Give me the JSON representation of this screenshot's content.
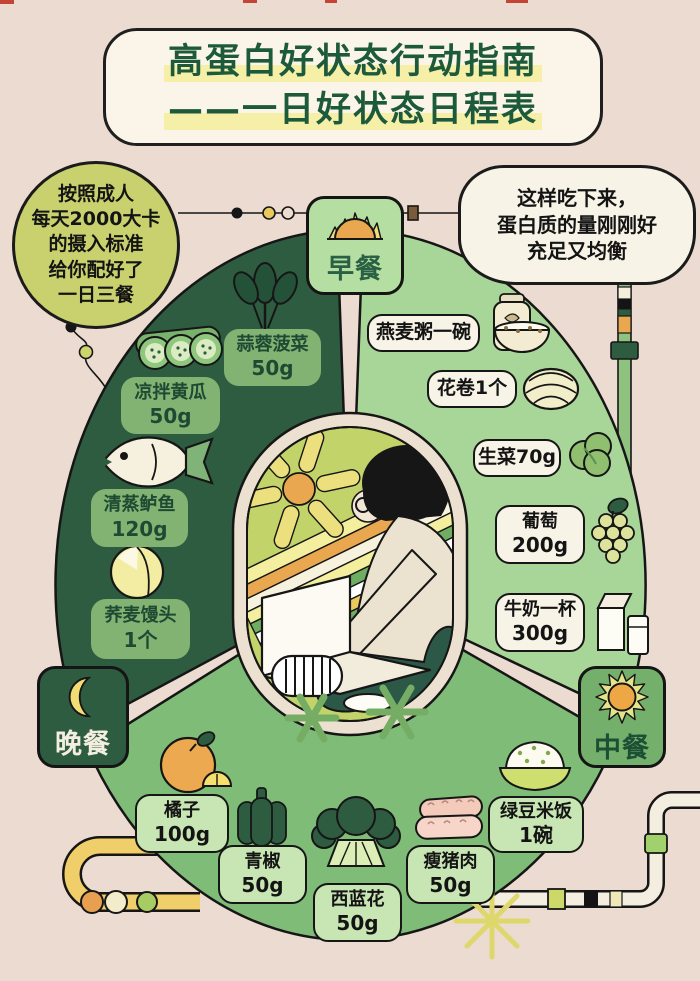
{
  "title": {
    "line1": "高蛋白好状态行动指南",
    "line2": "——一日好状态日程表"
  },
  "bubbles": {
    "left": {
      "lines": [
        "按照成人",
        "每天2000大卡",
        "的摄入标准",
        "给你配好了",
        "一日三餐"
      ]
    },
    "right": {
      "lines": [
        "这样吃下来，",
        "蛋白质的量刚刚好",
        "充足又均衡"
      ]
    }
  },
  "meals": {
    "breakfast": {
      "label": "早餐",
      "icon": "rising-sun-icon",
      "items": [
        {
          "line1": "燕麦粥一碗",
          "icon": "oatmeal-bowl-icon"
        },
        {
          "line1": "花卷1个",
          "icon": "steamed-roll-icon"
        },
        {
          "line1": "生菜70g",
          "icon": "lettuce-icon"
        },
        {
          "line1": "葡萄",
          "line2": "200g",
          "icon": "grapes-icon"
        },
        {
          "line1": "牛奶一杯",
          "line2": "300g",
          "icon": "milk-icon"
        }
      ]
    },
    "lunch": {
      "label": "中餐",
      "icon": "sun-icon",
      "items": [
        {
          "line1": "橘子",
          "line2": "100g",
          "icon": "tangerine-icon"
        },
        {
          "line1": "青椒",
          "line2": "50g",
          "icon": "green-pepper-icon"
        },
        {
          "line1": "西蓝花",
          "line2": "50g",
          "icon": "broccoli-icon"
        },
        {
          "line1": "瘦猪肉",
          "line2": "50g",
          "icon": "lean-pork-icon"
        },
        {
          "line1": "绿豆米饭",
          "line2": "1碗",
          "icon": "rice-bowl-icon"
        }
      ]
    },
    "dinner": {
      "label": "晚餐",
      "icon": "moon-icon",
      "items": [
        {
          "line1": "蒜蓉菠菜",
          "line2": "50g",
          "icon": "spinach-icon"
        },
        {
          "line1": "凉拌黄瓜",
          "line2": "50g",
          "icon": "cucumber-icon"
        },
        {
          "line1": "清蒸鲈鱼",
          "line2": "120g",
          "icon": "steamed-fish-icon"
        },
        {
          "line1": "荞麦馒头",
          "line2": "1个",
          "icon": "buckwheat-bun-icon"
        }
      ]
    }
  },
  "colors": {
    "background": "#ecdbd0",
    "title_text": "#1d5a3b",
    "title_highlight": "#f5efa8",
    "dinner_section": "#2e5c40",
    "breakfast_section": "#a8d698",
    "lunch_section": "#7fbc78",
    "dinner_label_box": "#82b373",
    "breakfast_label_box": "#f7f3e6",
    "lunch_label_box": "#c8e5b4",
    "badge_breakfast": "#b5dfa2",
    "badge_lunch": "#74b06c",
    "badge_dinner": "#2e5c40",
    "bubble_left": "#c9d06e",
    "bubble_right": "#f7f3e7",
    "accent_orange": "#e9a84f",
    "accent_yellow": "#f2dc74",
    "outline": "#161616"
  }
}
